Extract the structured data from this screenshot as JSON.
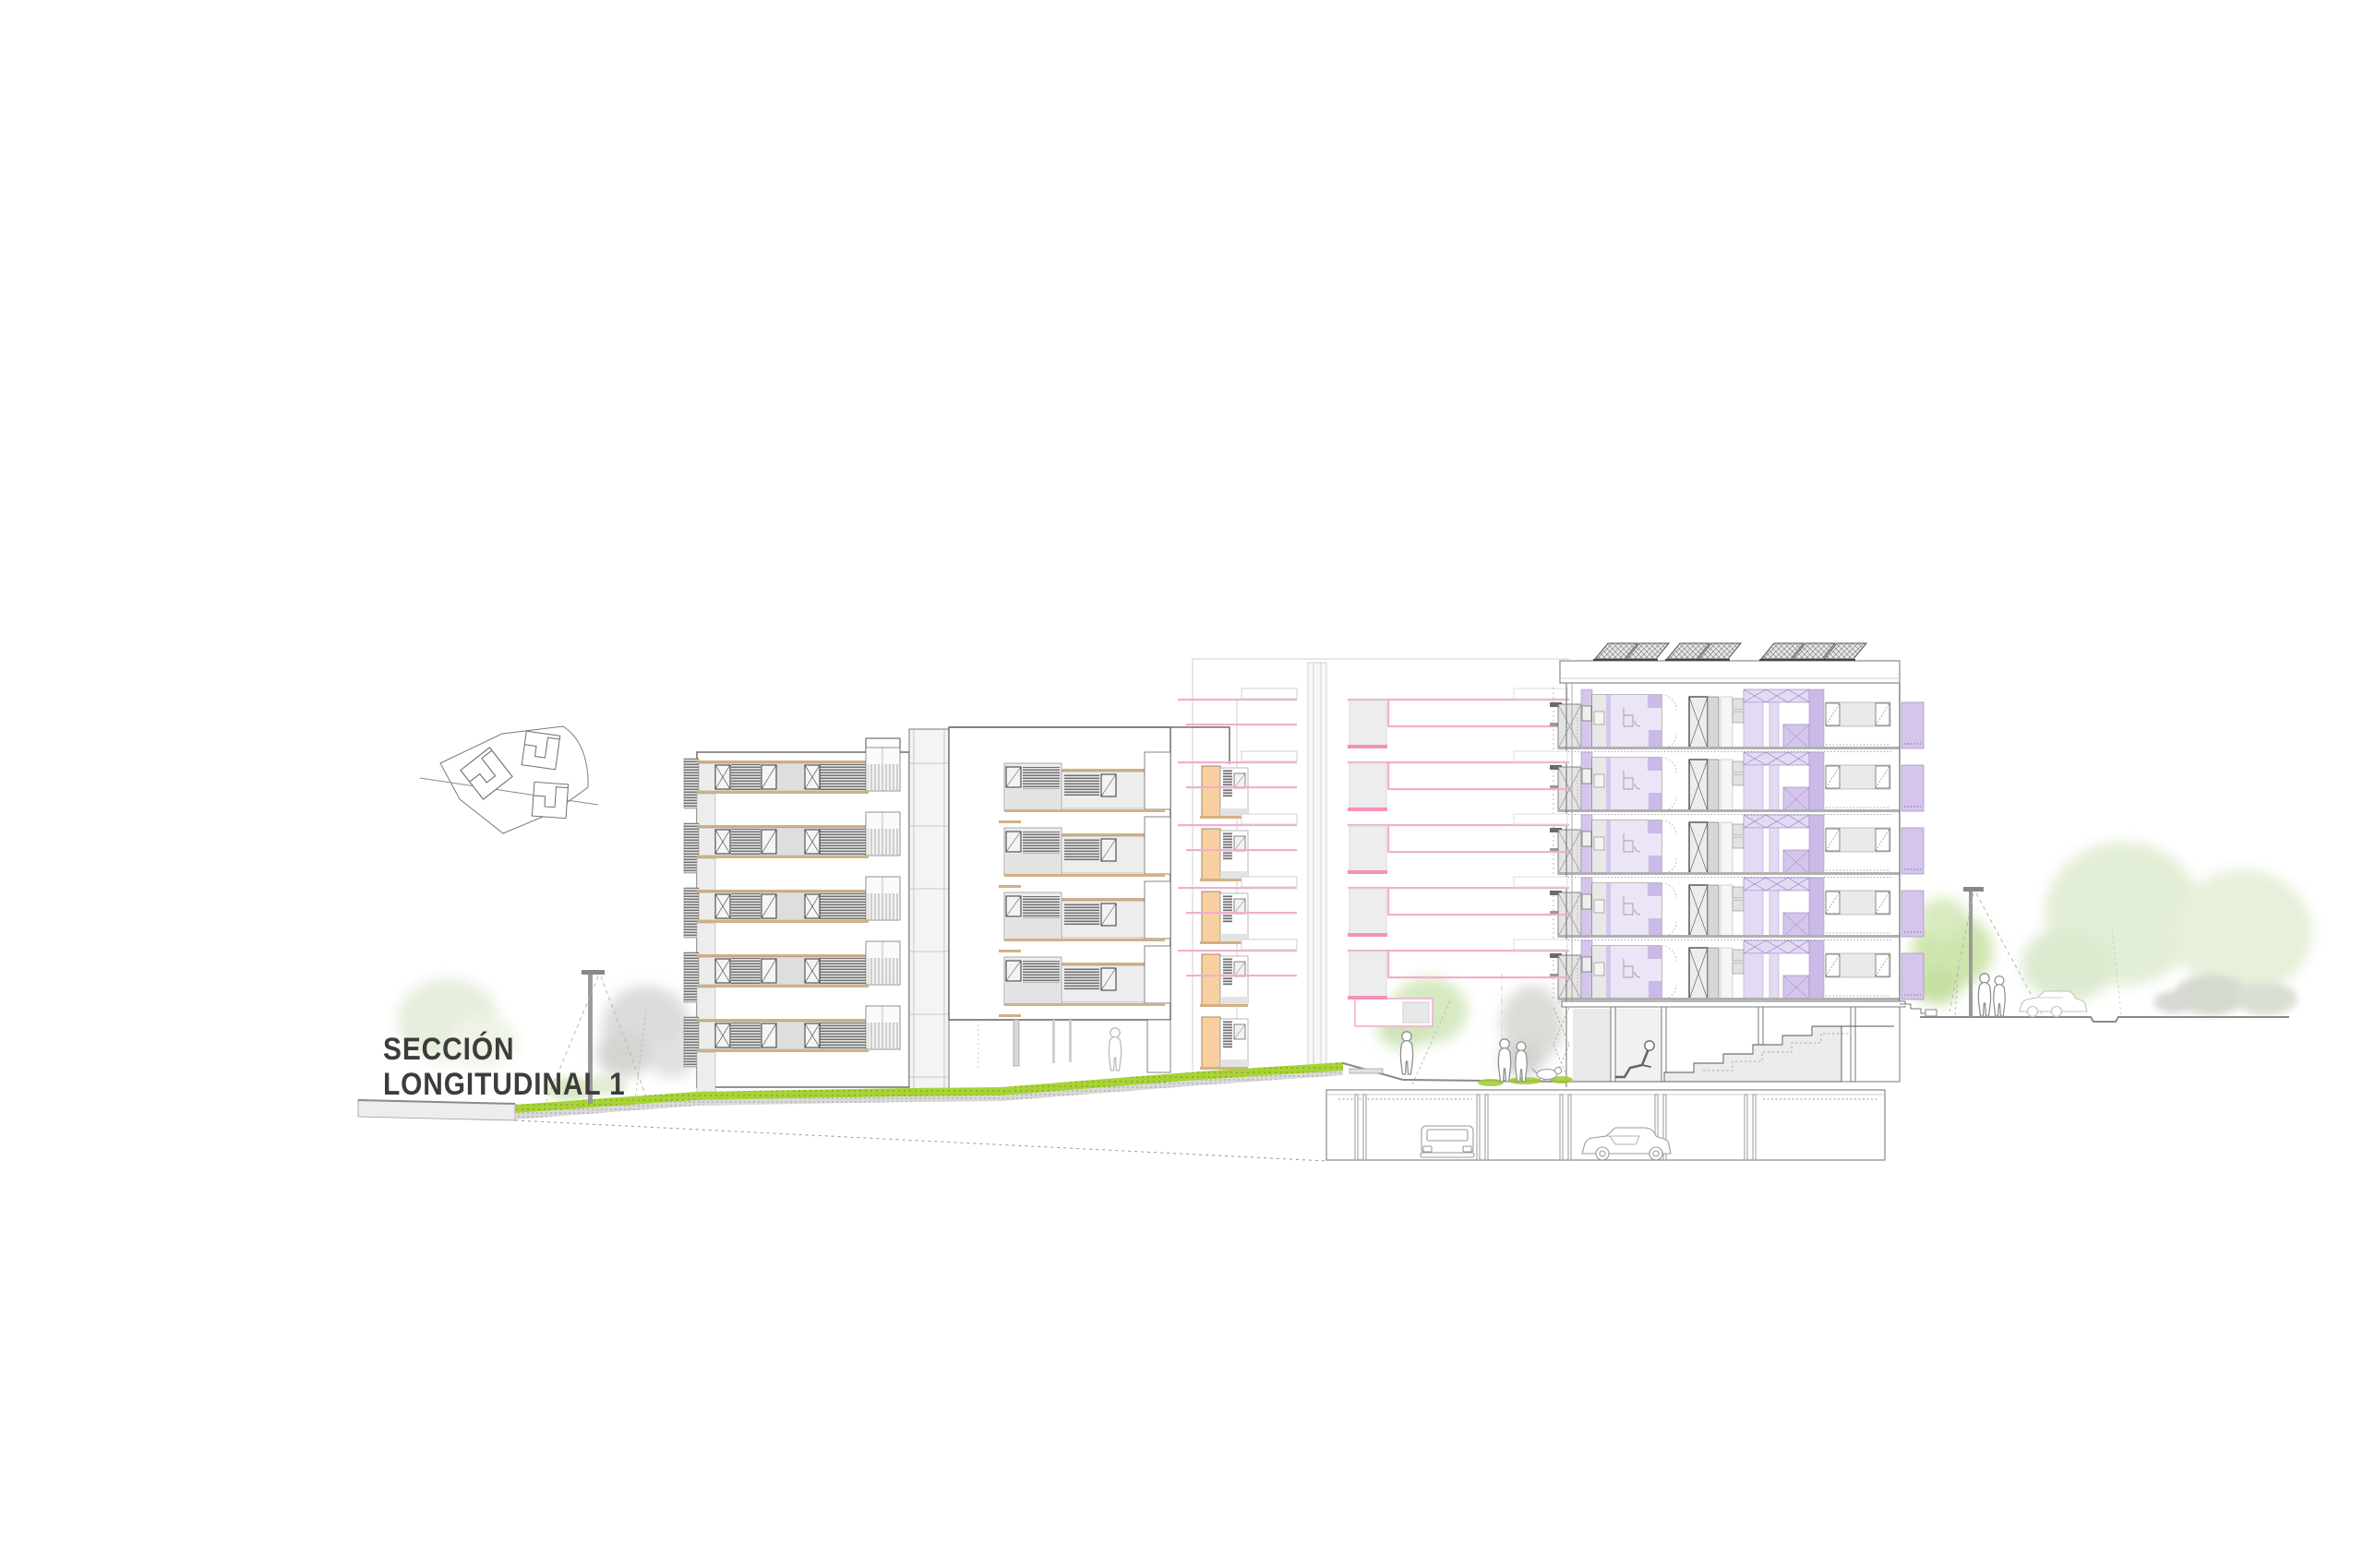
{
  "title": {
    "line1": "SECCIÓN",
    "line2": "LONGITUDINAL 1"
  },
  "drawing": {
    "type": "architectural-longitudinal-section",
    "left_block_floor_bands": 5,
    "middle_block_floors": 5,
    "right_block_floors": 5,
    "roof_solar_panel_groups": 3,
    "basement_parking_cars": 2,
    "street_cars": 1,
    "people": 7,
    "dogs": 1,
    "street_lamps": 2
  },
  "colors": {
    "purple": "#d5c5ec",
    "purpleLight": "#ece4f7",
    "purpleMid": "#cbb9e8",
    "purpleField": "#e4daf4",
    "peach": "#f8d0a0",
    "pink": "#f2aecd",
    "pinkBright": "#f590bb",
    "green": "#a8d335",
    "tan": "#d2b183",
    "treeGreen": "#d7e9c2",
    "treeGray": "#dcdcda",
    "wallWhite": "#ffffff",
    "panelGray": "#e9e9e9",
    "lineDark": "#555555"
  }
}
